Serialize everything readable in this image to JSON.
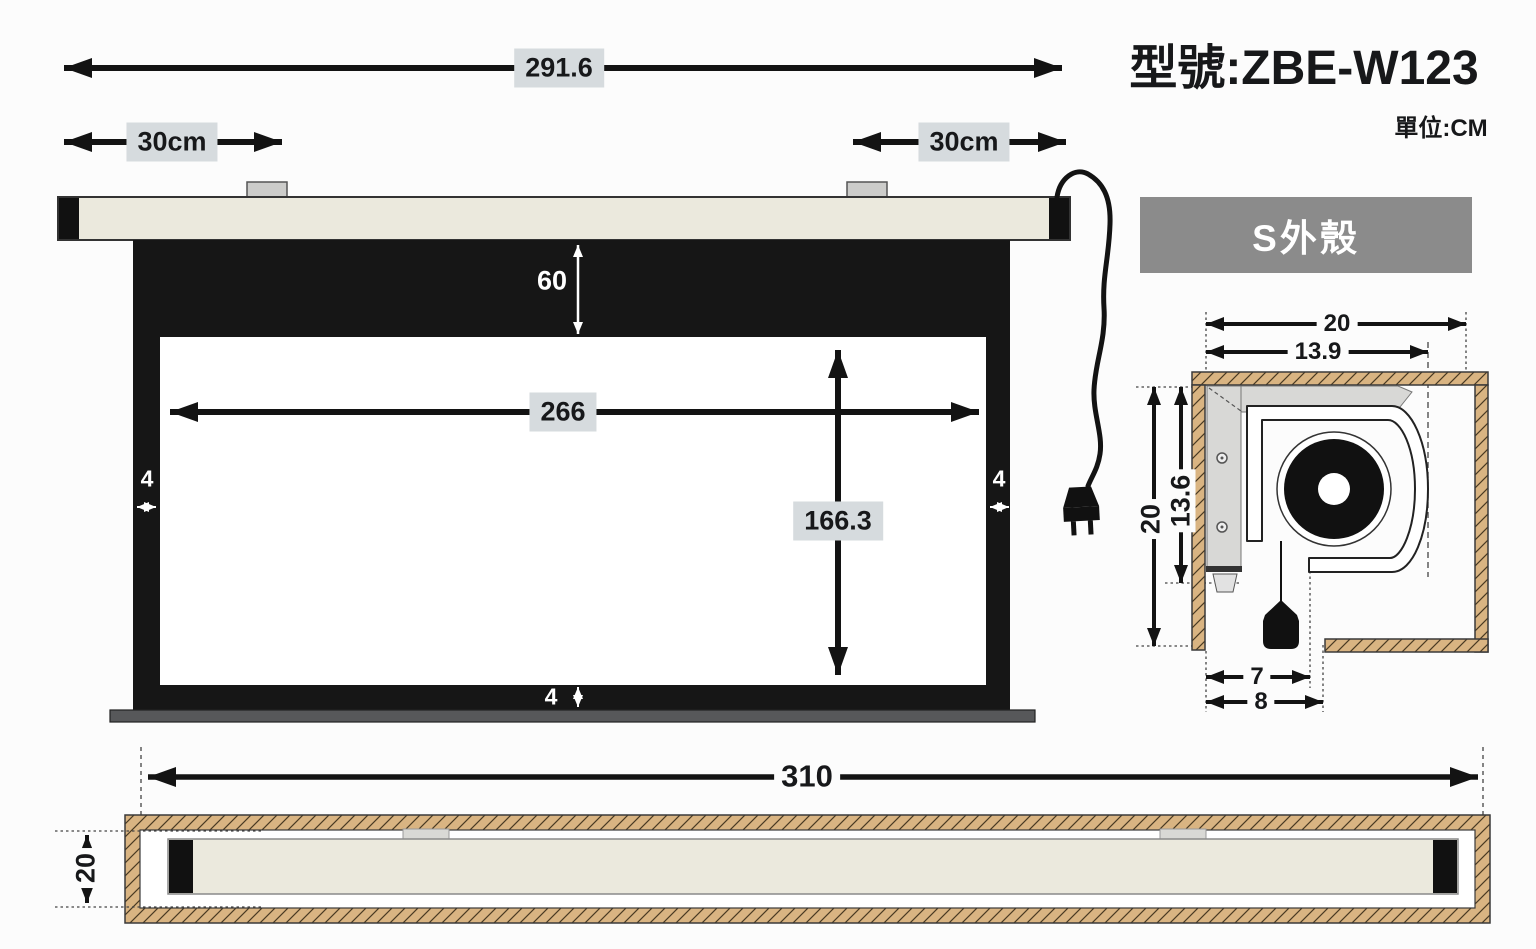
{
  "title": "型號:ZBE-W123",
  "unit_label": "單位:CM",
  "shell_label": "S外殼",
  "front_view": {
    "total_width": "291.6",
    "left_bracket_offset": "30cm",
    "right_bracket_offset": "30cm",
    "top_black_drop": "60",
    "viewing_width": "266",
    "viewing_height": "166.3",
    "left_border": "4",
    "right_border": "4",
    "bottom_border": "4"
  },
  "cross_section": {
    "recess_width": "20",
    "housing_width": "13.9",
    "recess_height": "20",
    "housing_height": "13.6",
    "slot_width": "7",
    "slot_clearance": "8"
  },
  "bottom_view": {
    "recess_length": "310",
    "recess_depth": "20"
  },
  "colors": {
    "casing": "#ebe9dd",
    "screen_border": "#161616",
    "dim_label_bg": "#d6dbde",
    "shell_box_bg": "#8b8b8b",
    "wood_hatch": "#d9b482",
    "weight_bar": "#57585a"
  }
}
